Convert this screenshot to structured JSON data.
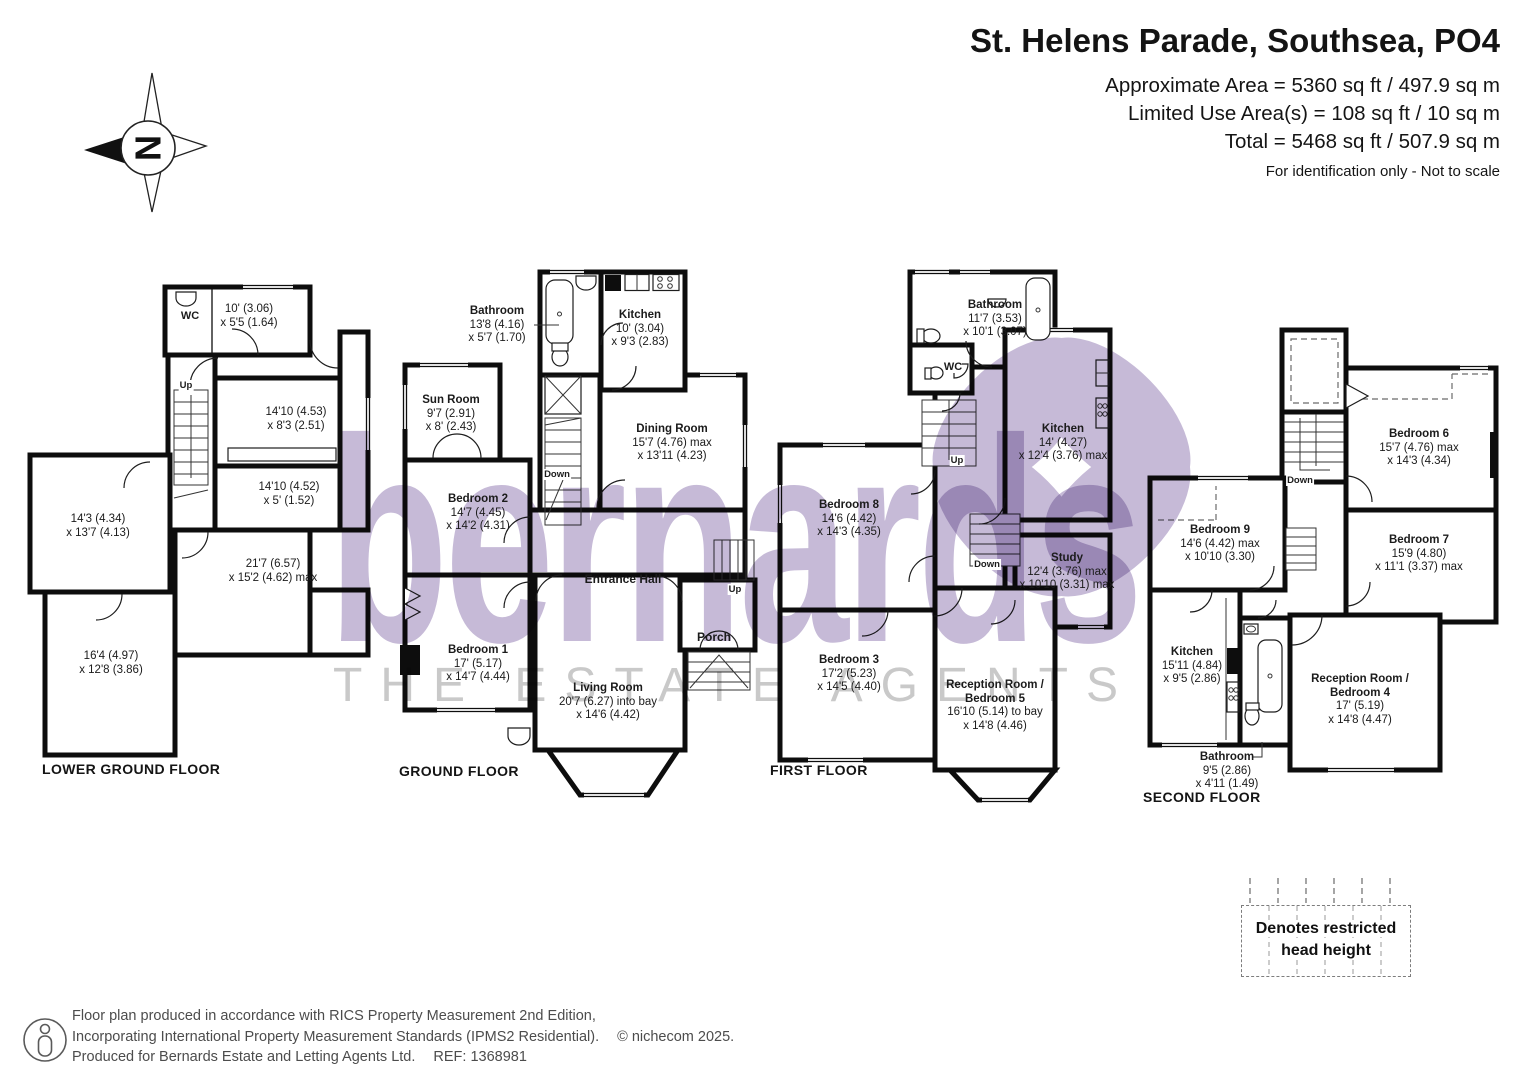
{
  "header": {
    "title": "St. Helens Parade, Southsea, PO4",
    "area_line1": "Approximate Area = 5360 sq ft / 497.9 sq m",
    "area_line2": "Limited Use Area(s) = 108 sq ft / 10 sq m",
    "area_line3": "Total = 5468 sq ft / 507.9 sq m",
    "note": "For identification only - Not to scale"
  },
  "compass": {
    "north_label": "N"
  },
  "watermark": {
    "brand": "bernards",
    "tagline": "THE ESTATE AGENTS",
    "brand_color": "#c6bad7",
    "tagline_color": "#c9c9c9"
  },
  "floors": [
    {
      "caption": "LOWER GROUND FLOOR",
      "labels": {
        "wc": "WC",
        "up": "Up",
        "room_10": {
          "d1": "10' (3.06)",
          "d2": "x 5'5 (1.64)"
        },
        "room_1410a": {
          "d1": "14'10 (4.53)",
          "d2": "x 8'3 (2.51)"
        },
        "room_1410b": {
          "d1": "14'10 (4.52)",
          "d2": "x 5' (1.52)"
        },
        "room_143": {
          "d1": "14'3 (4.34)",
          "d2": "x 13'7 (4.13)"
        },
        "room_217": {
          "d1": "21'7 (6.57)",
          "d2": "x 15'2 (4.62) max"
        },
        "room_164": {
          "d1": "16'4 (4.97)",
          "d2": "x 12'8 (3.86)"
        }
      }
    },
    {
      "caption": "GROUND FLOOR",
      "labels": {
        "bathroom": {
          "name": "Bathroom",
          "d1": "13'8 (4.16)",
          "d2": "x 5'7 (1.70)"
        },
        "kitchen": {
          "name": "Kitchen",
          "d1": "10' (3.04)",
          "d2": "x 9'3 (2.83)"
        },
        "sun_room": {
          "name": "Sun Room",
          "d1": "9'7 (2.91)",
          "d2": "x 8' (2.43)"
        },
        "dining_room": {
          "name": "Dining Room",
          "d1": "15'7 (4.76) max",
          "d2": "x 13'11 (4.23)"
        },
        "bedroom2": {
          "name": "Bedroom 2",
          "d1": "14'7 (4.45)",
          "d2": "x 14'2 (4.31)"
        },
        "entrance_hall": "Entrance Hall",
        "bedroom1": {
          "name": "Bedroom 1",
          "d1": "17' (5.17)",
          "d2": "x 14'7 (4.44)"
        },
        "living_room": {
          "name": "Living Room",
          "d1": "20'7 (6.27) into bay",
          "d2": "x 14'6 (4.42)"
        },
        "porch": "Porch",
        "up": "Up",
        "down": "Down"
      }
    },
    {
      "caption": "FIRST FLOOR",
      "labels": {
        "bathroom": {
          "name": "Bathroom",
          "d1": "11'7 (3.53)",
          "d2": "x 10'1 (3.07)"
        },
        "wc": "WC",
        "kitchen": {
          "name": "Kitchen",
          "d1": "14' (4.27)",
          "d2": "x 12'4 (3.76) max"
        },
        "bedroom8": {
          "name": "Bedroom 8",
          "d1": "14'6 (4.42)",
          "d2": "x 14'3 (4.35)"
        },
        "study": {
          "name": "Study",
          "d1": "12'4 (3.76) max",
          "d2": "x 10'10 (3.31) max"
        },
        "bedroom3": {
          "name": "Bedroom 3",
          "d1": "17'2 (5.23)",
          "d2": "x 14'5 (4.40)"
        },
        "reception5": {
          "name": "Reception Room /",
          "name2": "Bedroom 5",
          "d1": "16'10 (5.14) to bay",
          "d2": "x 14'8 (4.46)"
        },
        "up": "Up",
        "down": "Down"
      }
    },
    {
      "caption": "SECOND FLOOR",
      "labels": {
        "bedroom6": {
          "name": "Bedroom 6",
          "d1": "15'7 (4.76) max",
          "d2": "x 14'3 (4.34)"
        },
        "bedroom9": {
          "name": "Bedroom 9",
          "d1": "14'6 (4.42) max",
          "d2": "x 10'10 (3.30)"
        },
        "bedroom7": {
          "name": "Bedroom 7",
          "d1": "15'9 (4.80)",
          "d2": "x 11'1 (3.37) max"
        },
        "kitchen": {
          "name": "Kitchen",
          "d1": "15'11 (4.84)",
          "d2": "x 9'5 (2.86)"
        },
        "bathroom": {
          "name": "Bathroom",
          "d1": "9'5 (2.86)",
          "d2": "x 4'11 (1.49)"
        },
        "reception4": {
          "name": "Reception Room /",
          "name2": "Bedroom 4",
          "d1": "17' (5.19)",
          "d2": "x 14'8 (4.47)"
        },
        "down": "Down"
      }
    }
  ],
  "legend": {
    "line1": "Denotes restricted",
    "line2": "head height"
  },
  "footer": {
    "line1": "Floor plan produced in accordance with RICS Property Measurement 2nd Edition,",
    "line2": "Incorporating International Property Measurement Standards (IPMS2 Residential).",
    "copyright": "© nichecom 2025.",
    "line3": "Produced for Bernards Estate and Letting Agents Ltd.",
    "ref": "REF:  1368981"
  }
}
